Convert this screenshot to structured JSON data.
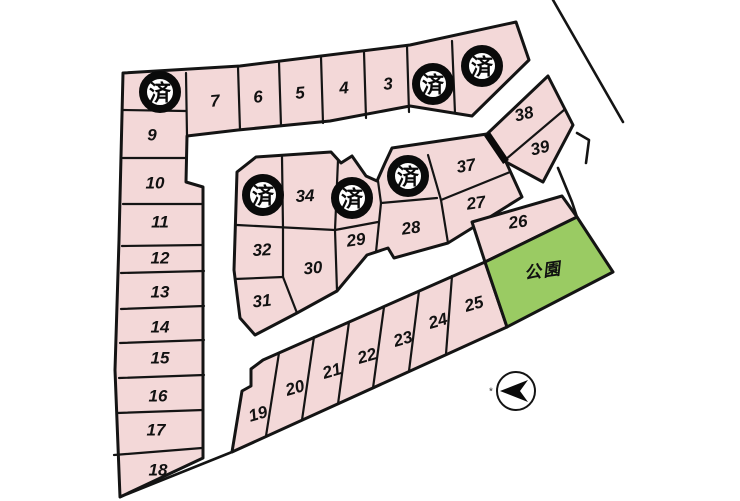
{
  "colors": {
    "background": "#FFFFFF",
    "lot_fill": "#F3D8D8",
    "park_fill": "#9ACB63",
    "line": "#141414"
  },
  "map": {
    "blocks": [
      {
        "name": "north-band-and-west-column",
        "points": "123,73 240,66 410,45 516,22 529,60 472,116 410,106 330,121 238,130 187,136 186,182 203,187 203,458 120,497 115,370 119,240"
      },
      {
        "name": "central-block",
        "points": "237,172 256,157 331,152 341,163 352,156 366,176 377,181 385,163 392,148 487,134 506,162 522,197 448,243 394,258 388,248 367,255 337,291 297,313 255,335 240,318 234,270"
      },
      {
        "name": "northeast-block-38-39",
        "points": "548,76 573,125 543,182 506,162 487,134"
      },
      {
        "name": "lot-26-strip",
        "points": "472,222 562,196 577,217 485,262"
      },
      {
        "name": "south-strip-19-25",
        "points": "263,360 485,262 507,327 232,452 242,391 251,386 251,369"
      }
    ],
    "dividers": [
      "186,73 187,136",
      "238,67 240,130",
      "279,62 281,126",
      "321,57 323,123",
      "364,52 366,118",
      "407,46 409,112",
      "452,41 455,113",
      "123,110 186,111",
      "123,158 186,158",
      "123,204 203,204",
      "122,246 203,245",
      "121,273 204,271",
      "121,309 204,306",
      "120,343 204,340",
      "119,378 204,375",
      "117,413 203,410",
      "114,455 202,448",
      "282,157 283,228",
      "338,160 335,230",
      "237,225 335,230",
      "335,230 378,222",
      "335,230 337,291",
      "235,279 283,277",
      "283,228 283,277",
      "283,277 297,313",
      "378,181 381,203",
      "381,203 376,252",
      "381,203 437,198",
      "428,155 441,200",
      "441,200 510,172",
      "441,200 448,243",
      "564,110 505,160",
      "279,353 266,436",
      "314,337 302,420",
      "349,322 338,404",
      "384,307 373,388",
      "419,291 409,371",
      "452,276 446,354"
    ],
    "walls": [
      "487,134 506,162"
    ],
    "roads": [
      "553,0 623,122",
      "577,133 589,140 586,163",
      "558,168 572,202 577,217",
      "120,497 232,452"
    ],
    "park": {
      "label": "公園",
      "points": "485,262 577,217 613,272 507,327",
      "label_x": 543,
      "label_y": 271,
      "label_rot": -8
    },
    "lot_labels": [
      {
        "no": "3",
        "x": 388,
        "y": 84,
        "rot": -5
      },
      {
        "no": "4",
        "x": 344,
        "y": 88,
        "rot": -5
      },
      {
        "no": "5",
        "x": 300,
        "y": 93,
        "rot": -5
      },
      {
        "no": "6",
        "x": 258,
        "y": 97,
        "rot": -5
      },
      {
        "no": "7",
        "x": 215,
        "y": 101,
        "rot": -5
      },
      {
        "no": "9",
        "x": 152,
        "y": 135,
        "rot": 0
      },
      {
        "no": "10",
        "x": 155,
        "y": 183,
        "rot": 0
      },
      {
        "no": "11",
        "x": 160,
        "y": 222,
        "rot": 0
      },
      {
        "no": "12",
        "x": 160,
        "y": 258,
        "rot": 0
      },
      {
        "no": "13",
        "x": 160,
        "y": 292,
        "rot": 0
      },
      {
        "no": "14",
        "x": 160,
        "y": 327,
        "rot": 0
      },
      {
        "no": "15",
        "x": 160,
        "y": 358,
        "rot": 0
      },
      {
        "no": "16",
        "x": 158,
        "y": 396,
        "rot": 0
      },
      {
        "no": "17",
        "x": 156,
        "y": 430,
        "rot": 0
      },
      {
        "no": "18",
        "x": 158,
        "y": 470,
        "rot": 0
      },
      {
        "no": "19",
        "x": 258,
        "y": 414,
        "rot": -16
      },
      {
        "no": "20",
        "x": 295,
        "y": 388,
        "rot": -16
      },
      {
        "no": "21",
        "x": 332,
        "y": 371,
        "rot": -16
      },
      {
        "no": "22",
        "x": 367,
        "y": 356,
        "rot": -16
      },
      {
        "no": "23",
        "x": 403,
        "y": 339,
        "rot": -16
      },
      {
        "no": "24",
        "x": 438,
        "y": 321,
        "rot": -16
      },
      {
        "no": "25",
        "x": 474,
        "y": 304,
        "rot": -16
      },
      {
        "no": "26",
        "x": 518,
        "y": 222,
        "rot": -8
      },
      {
        "no": "27",
        "x": 476,
        "y": 203,
        "rot": -8
      },
      {
        "no": "28",
        "x": 411,
        "y": 228,
        "rot": -8
      },
      {
        "no": "29",
        "x": 356,
        "y": 240,
        "rot": -8
      },
      {
        "no": "30",
        "x": 313,
        "y": 268,
        "rot": -6
      },
      {
        "no": "31",
        "x": 262,
        "y": 301,
        "rot": -6
      },
      {
        "no": "32",
        "x": 262,
        "y": 250,
        "rot": -3
      },
      {
        "no": "34",
        "x": 305,
        "y": 196,
        "rot": -3
      },
      {
        "no": "37",
        "x": 466,
        "y": 166,
        "rot": -10
      },
      {
        "no": "38",
        "x": 524,
        "y": 114,
        "rot": -14
      },
      {
        "no": "39",
        "x": 540,
        "y": 148,
        "rot": -14
      }
    ],
    "sold_badges": {
      "label": "済",
      "radius": 17,
      "positions": [
        {
          "x": 160,
          "y": 92
        },
        {
          "x": 433,
          "y": 84
        },
        {
          "x": 482,
          "y": 66
        },
        {
          "x": 263,
          "y": 195
        },
        {
          "x": 352,
          "y": 198
        },
        {
          "x": 408,
          "y": 176
        }
      ]
    },
    "compass": {
      "cx": 516,
      "cy": 391,
      "r": 19,
      "arrow": "500,391 528,380 520,391 528,402",
      "mark": "*",
      "mark_x": 491,
      "mark_y": 392
    }
  }
}
